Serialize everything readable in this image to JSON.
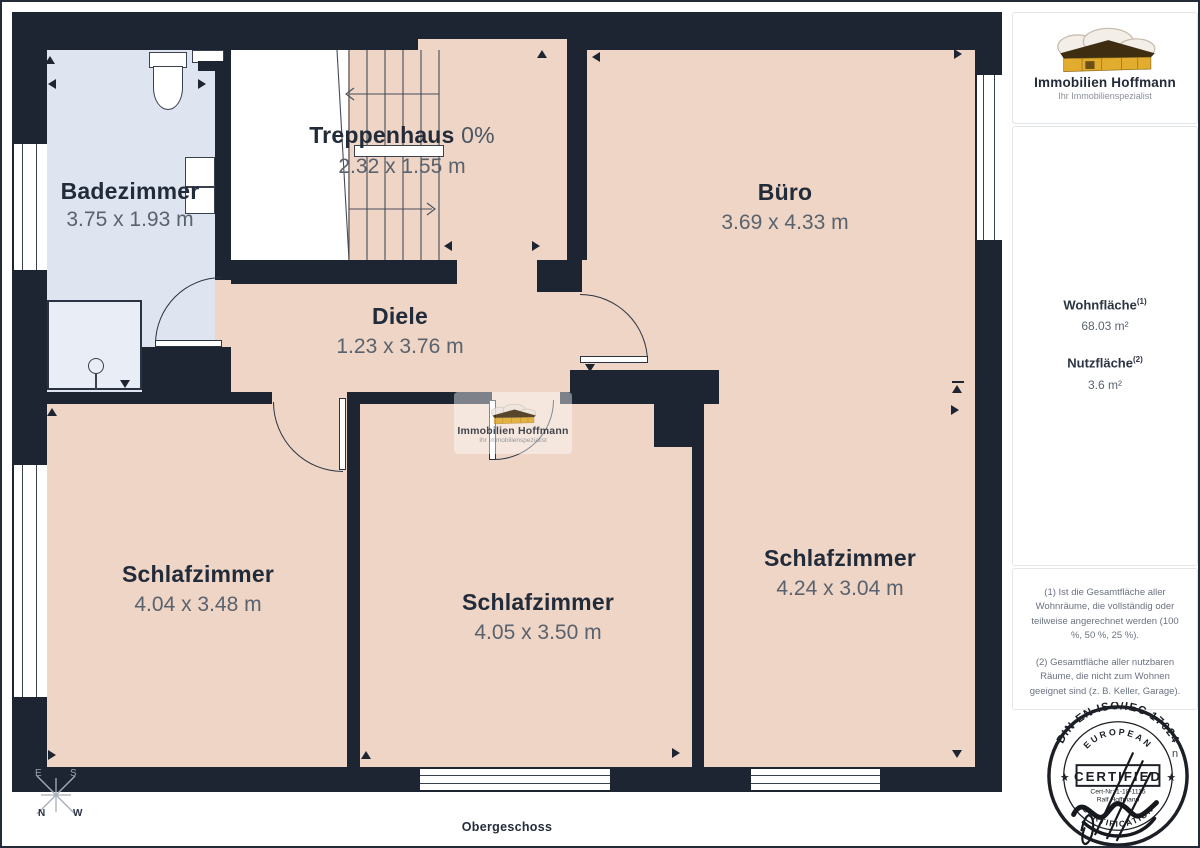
{
  "page": {
    "floor_label": "Obergeschoss"
  },
  "logo": {
    "title": "Immobilien Hoffmann",
    "subtitle": "Ihr Immobilienspezialist"
  },
  "rooms": {
    "badezimmer": {
      "name": "Badezimmer",
      "dims": "3.75 x 1.93 m"
    },
    "treppenhaus": {
      "name": "Treppenhaus",
      "suffix": "0%",
      "dims": "2.32 x 1.55 m"
    },
    "buero": {
      "name": "Büro",
      "dims": "3.69 x 4.33 m"
    },
    "diele": {
      "name": "Diele",
      "dims": "1.23 x 3.76 m"
    },
    "schlafzimmer_links": {
      "name": "Schlafzimmer",
      "dims": "4.04 x 3.48 m"
    },
    "schlafzimmer_mitte": {
      "name": "Schlafzimmer",
      "dims": "4.05 x 3.50 m"
    },
    "schlafzimmer_rechts": {
      "name": "Schlafzimmer",
      "dims": "4.24 x 3.04 m"
    }
  },
  "sidebar": {
    "wohnflaeche": {
      "label": "Wohnfläche",
      "sup": "(1)",
      "value": "68.03 m²"
    },
    "nutzflaeche": {
      "label": "Nutzfläche",
      "sup": "(2)",
      "value": "3.6 m²"
    },
    "footnote1": "(1) Ist die Gesamtfläche aller Wohnräume, die vollständig oder teilweise angerechnet werden (100 %, 50 %, 25 %).",
    "footnote2": "(2) Gesamtfläche aller nutzbaren Räume, die nicht zum Wohnen geeignet sind (z. B. Keller, Garage)."
  },
  "stamp": {
    "arc_top": "DIN EN ISO/IEC 17024",
    "arc_inner": "EUROPEAN",
    "center": "CERTIFIED",
    "cert_nr": "Cert-Nr: 1-18-1115",
    "name": "Ralf Hoffmann",
    "arc_bottom": "CERTIFICATION",
    "star": "★",
    "stray": "n"
  },
  "compass": {
    "e": "E",
    "s": "S",
    "n": "N",
    "w": "W"
  },
  "colors": {
    "wall": "#1d2533",
    "room": "#eed5c5",
    "bath": "#dfe5f0",
    "accent": "#e2ac2e",
    "ink": "#1c2026"
  }
}
